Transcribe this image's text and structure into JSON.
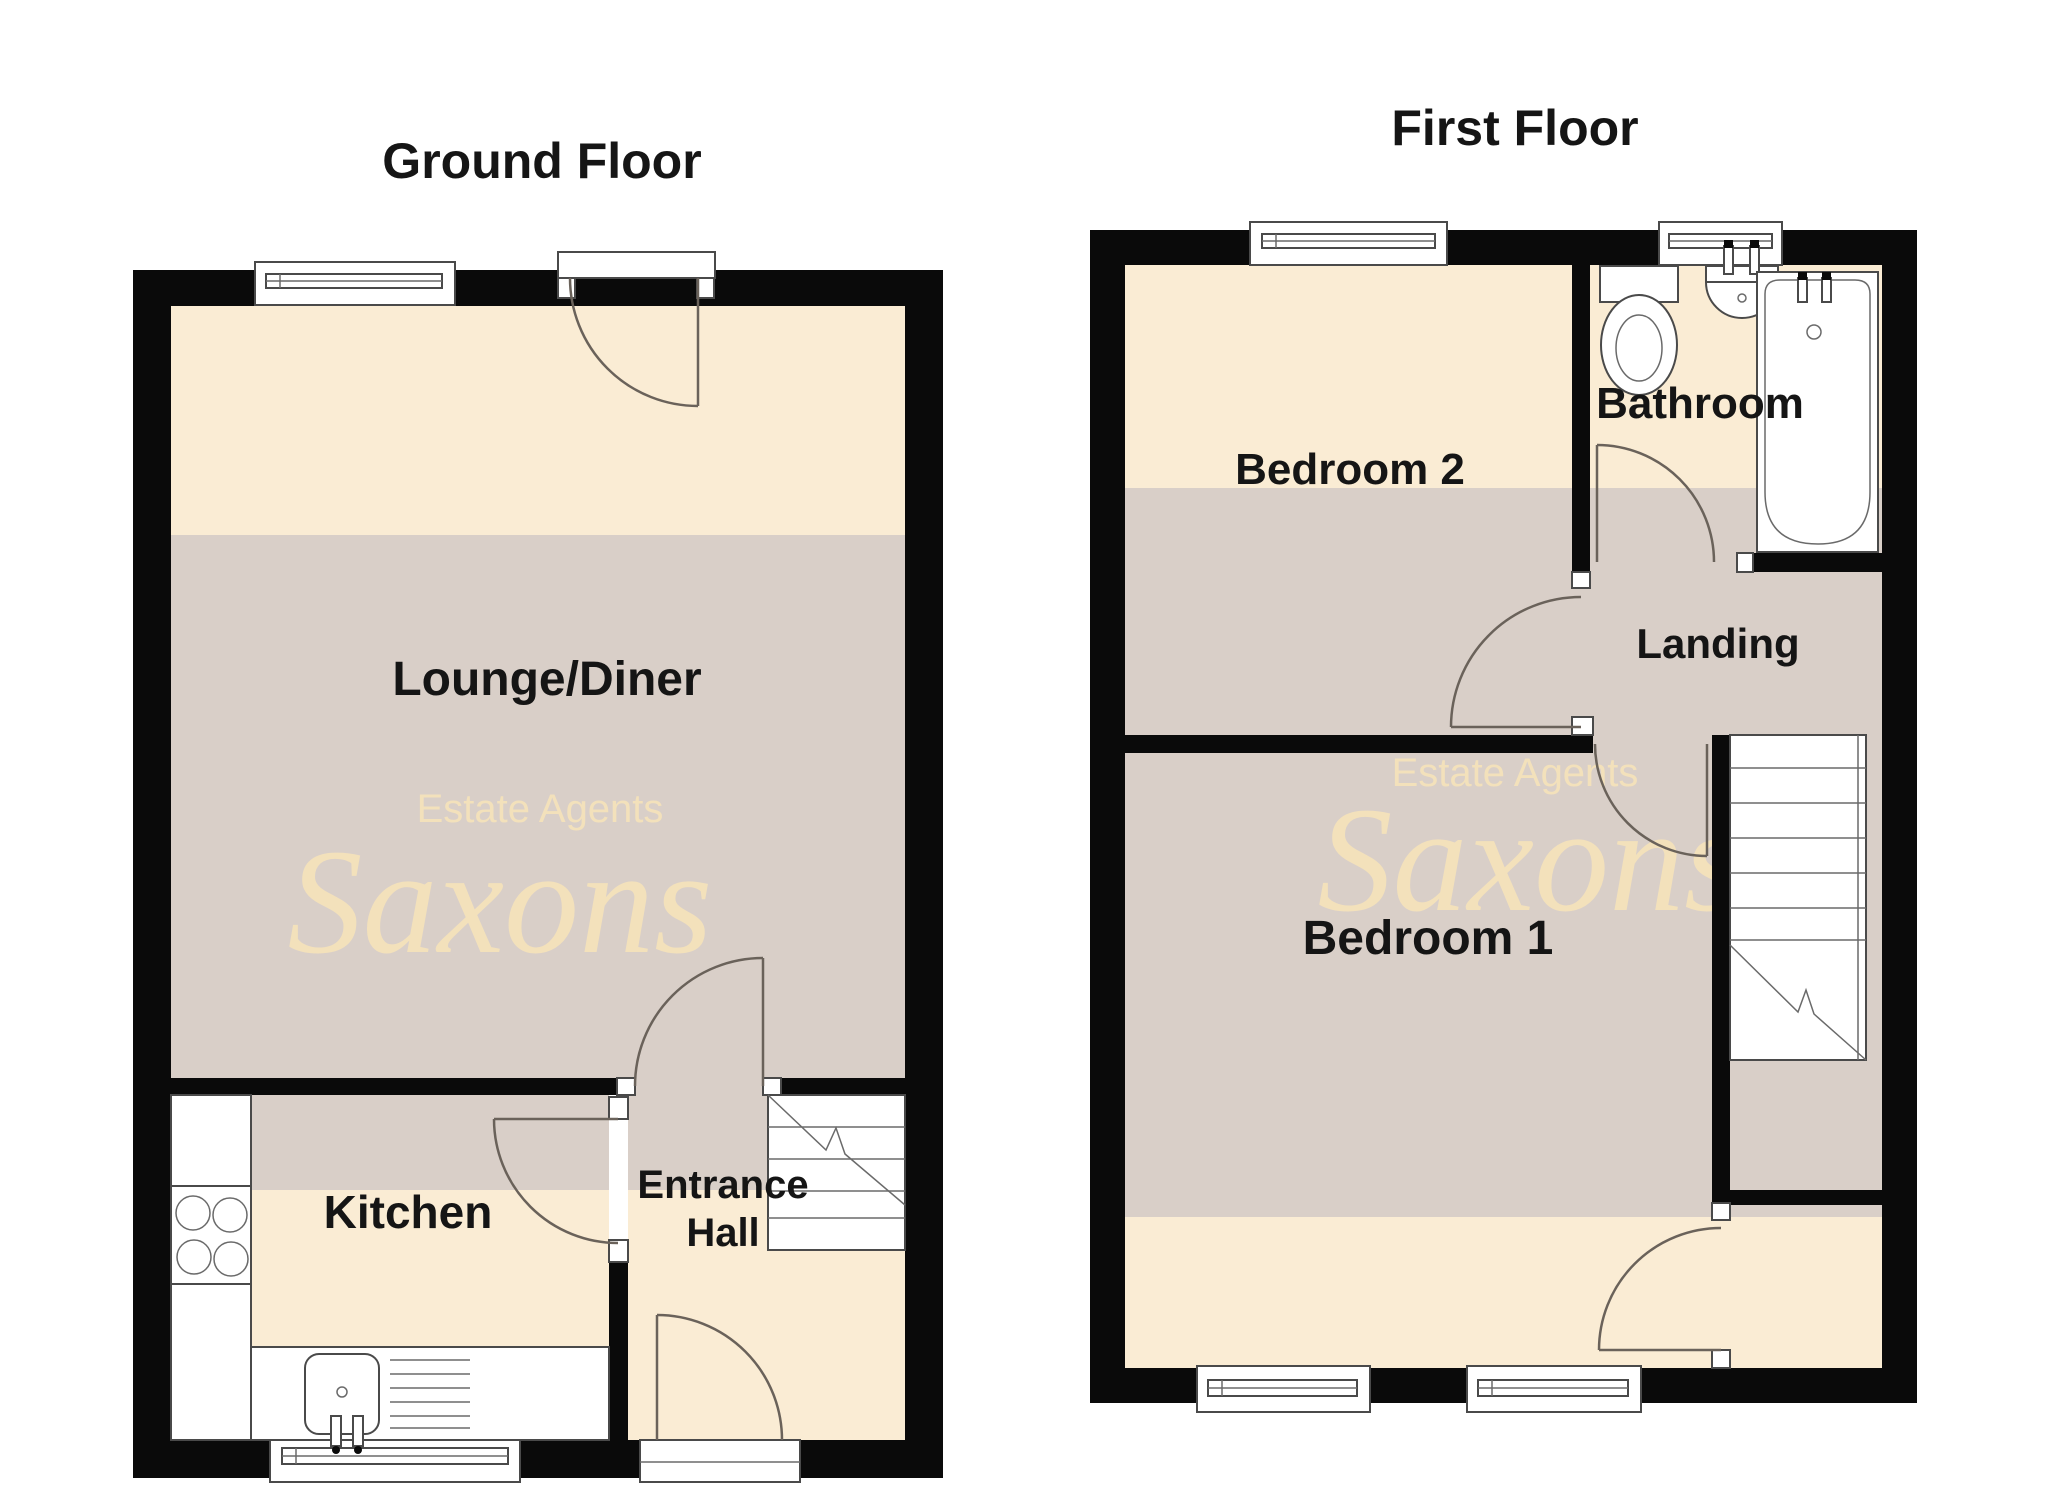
{
  "page": {
    "background": "#ffffff"
  },
  "colors": {
    "wall": "#0a0a0a",
    "room_light": "#FAECD4",
    "room_shaded": "#D9CFC8",
    "watermark": "#F5E2BB",
    "label_text": "#151515",
    "fixture_line": "#4a4a4a",
    "door_arc": "#6a625a"
  },
  "ground_floor": {
    "title": "Ground Floor",
    "rooms": {
      "lounge": {
        "label": "Lounge/Diner"
      },
      "kitchen": {
        "label": "Kitchen"
      },
      "entrance_hall": {
        "line1": "Entrance",
        "line2": "Hall"
      }
    },
    "watermark": {
      "tagline": "Estate Agents",
      "brand": "Saxons"
    }
  },
  "first_floor": {
    "title": "First Floor",
    "rooms": {
      "bedroom2": {
        "label": "Bedroom 2"
      },
      "bathroom": {
        "label": "Bathroom"
      },
      "landing": {
        "label": "Landing"
      },
      "bedroom1": {
        "label": "Bedroom 1"
      }
    },
    "watermark": {
      "tagline": "Estate Agents",
      "brand": "Saxons"
    }
  }
}
